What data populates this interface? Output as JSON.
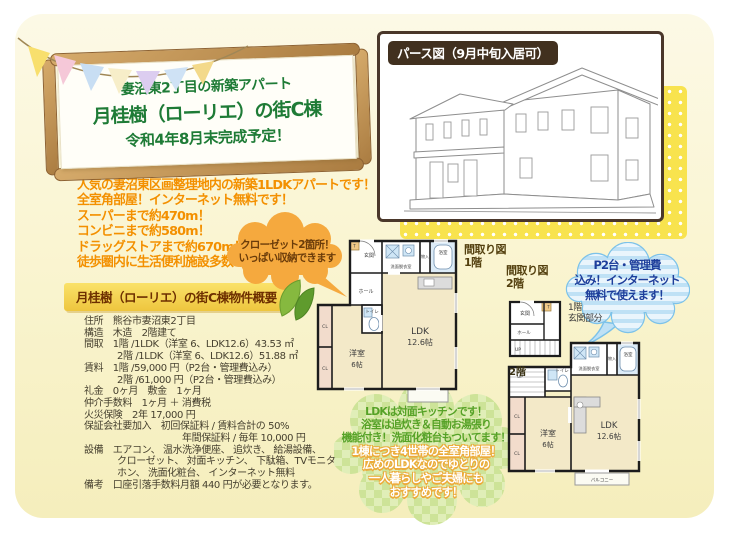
{
  "colors": {
    "page_bg": "#faf5d2",
    "sign_text_green": "#1e7b36",
    "wood": "#c69a5c",
    "highlight_orange": "#f39000",
    "bubble_orange": "#f5a93e",
    "dot_yellow": "#f8e34e",
    "pers_label_brown": "#41301f",
    "parking_text_navy": "#1d3e9b",
    "feature_text_green": "#56a227",
    "plan_floor_beige": "#f3e9c8",
    "plan_wet_blue": "#dcebf7"
  },
  "banner": {
    "line1": "妻沼東2丁目の新築アパート",
    "line2": "月桂樹（ローリエ）の街C棟",
    "line3": "令和4年8月末完成予定！"
  },
  "pers": {
    "label": "パース図（9月中旬入居可）"
  },
  "highlights": [
    "人気の妻沼東区画整理地内の新築1LDKアパートです！",
    "全室角部屋！インターネット無料です！",
    "スーパーまで約470m！",
    "コンビニまで約580m！",
    "ドラッグストアまで約670m！",
    "徒歩圏内に生活便利施設多数あり！"
  ],
  "closet_bubble": {
    "line1": "クローゼット2箇所！",
    "line2": "いっぱい収納できます"
  },
  "overview": {
    "heading": "月桂樹（ローリエ）の街C棟物件概要",
    "lines": [
      {
        "t": "住所　熊谷市妻沼東2丁目",
        "ind": 0
      },
      {
        "t": "構造　木造　2階建て",
        "ind": 0
      },
      {
        "t": "間取　1階 /1LDK（洋室 6、LDK12.6）43.53 ㎡",
        "ind": 0
      },
      {
        "t": "2階 /1LDK（洋室 6、LDK12.6）51.88 ㎡",
        "ind": 1
      },
      {
        "t": "賃料　1階 /59,000 円（P2台・管理費込み）",
        "ind": 0
      },
      {
        "t": "2階 /61,000 円（P2台・管理費込み）",
        "ind": 1
      },
      {
        "t": "礼金　0ヶ月　敷金　1ヶ月",
        "ind": 0
      },
      {
        "t": "仲介手数料　1ヶ月 ＋ 消費税",
        "ind": 0
      },
      {
        "t": "火災保険　2年 17,000 円",
        "ind": 0
      },
      {
        "t": "保証会社要加入　初回保証料 / 賃料合計の 50%",
        "ind": 0
      },
      {
        "t": "年間保証料 / 毎年 10,000 円",
        "ind": 2
      },
      {
        "t": "設備　エアコン、 温水洗浄便座、 追炊き、 給湯設備、",
        "ind": 0
      },
      {
        "t": "クローゼット、 対面キッチン、 下駄箱、TVモニタ",
        "ind": 1
      },
      {
        "t": "ホン、 洗面化粧台、 インターネット無料",
        "ind": 1
      },
      {
        "t": "備考　口座引落手数料月額 440 円が必要となります。",
        "ind": 0
      }
    ]
  },
  "plans": {
    "f1_title_1": "間取り図",
    "f1_title_2": "1階",
    "f2_title_1": "間取り図",
    "f2_title_2": "2階",
    "entrance_note_1": "1階",
    "entrance_note_2": "玄関部分",
    "floor2_label": "2階"
  },
  "rooms": {
    "genkan": "玄関",
    "hall": "ホール",
    "wc": "トイレ",
    "wash": "洗面脱衣室",
    "bath": "浴室",
    "mono": "物入",
    "shoe": "T",
    "cl": "CL",
    "up": "UP",
    "western": "洋室",
    "western_size": "6帖",
    "ldk": "LDK",
    "ldk_size": "12.6帖",
    "balcony": "バルコニー"
  },
  "parking_bubble": {
    "lines": [
      "P2台・管理費",
      "込み！インターネット",
      "無料で使えます！"
    ]
  },
  "feature_bubble": {
    "green_lines": [
      "LDKは対面キッチンです！",
      "浴室は追炊き＆自動お湯張り",
      "機能付き！洗面化粧台もついてます！"
    ],
    "white_lines": [
      "1棟につき4世帯の全室角部屋！",
      "広めのLDKなのでゆとりの",
      "一人暮らしやご夫婦にも",
      "おすすめです！"
    ]
  }
}
